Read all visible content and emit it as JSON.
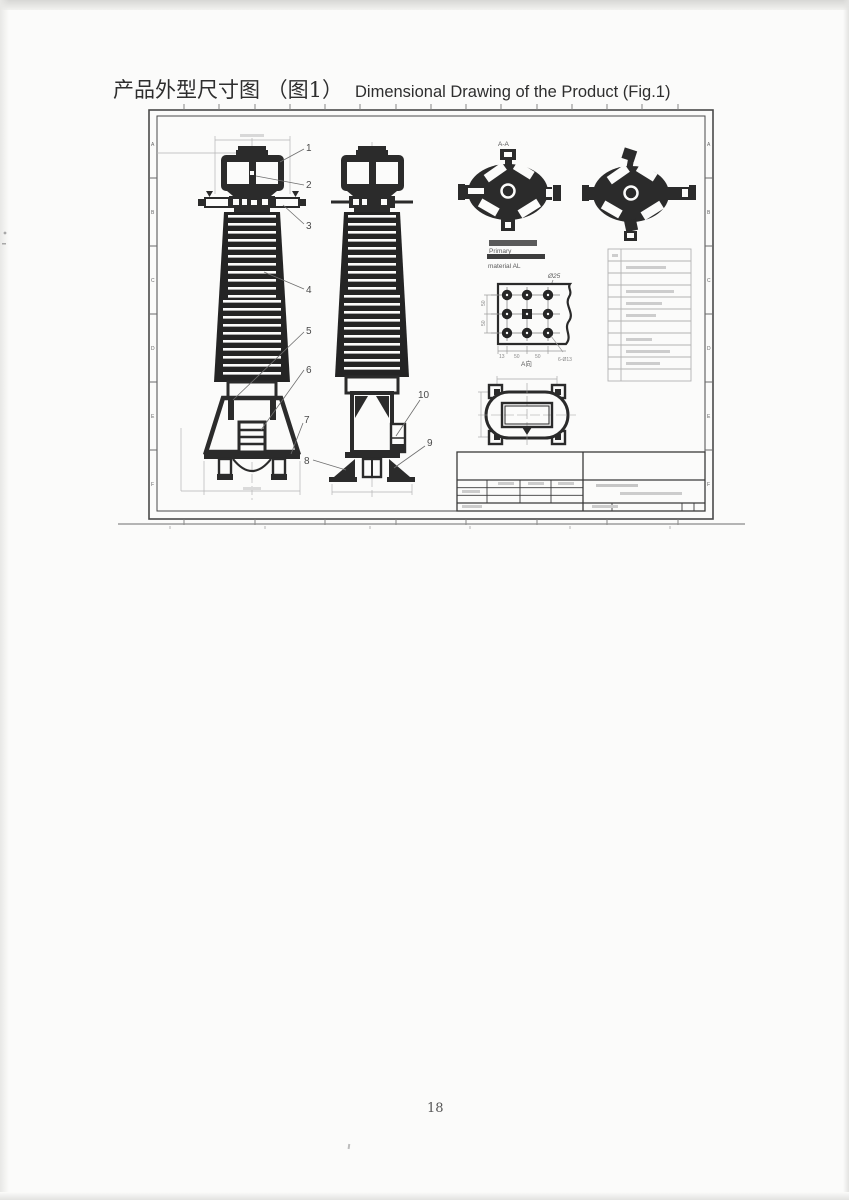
{
  "header": {
    "title_zh": "产品外型尺寸图 （图1）",
    "title_en": "Dimensional Drawing of the Product (Fig.1)"
  },
  "footer": {
    "page_number": "18"
  },
  "drawing": {
    "section_label": "A-A",
    "view_label": "A向",
    "callouts": [
      "1",
      "2",
      "3",
      "4",
      "5",
      "6",
      "7",
      "8",
      "9",
      "10"
    ],
    "notes": {
      "primary": "Primary",
      "material": "material AL"
    },
    "dims": {
      "washer": "Ø25",
      "holes": "6-Ø13",
      "v50a": "50",
      "v50b": "50",
      "b13": "13",
      "b50a": "50",
      "b50b": "50"
    },
    "zones_left": [
      "A",
      "B",
      "C",
      "D",
      "E",
      "F"
    ],
    "zones_right": [
      "A",
      "B",
      "C",
      "D",
      "E",
      "F"
    ]
  },
  "colors": {
    "ink": "#2b2b2b",
    "faint": "#b5b5b5",
    "dim": "#9a9a9a"
  }
}
